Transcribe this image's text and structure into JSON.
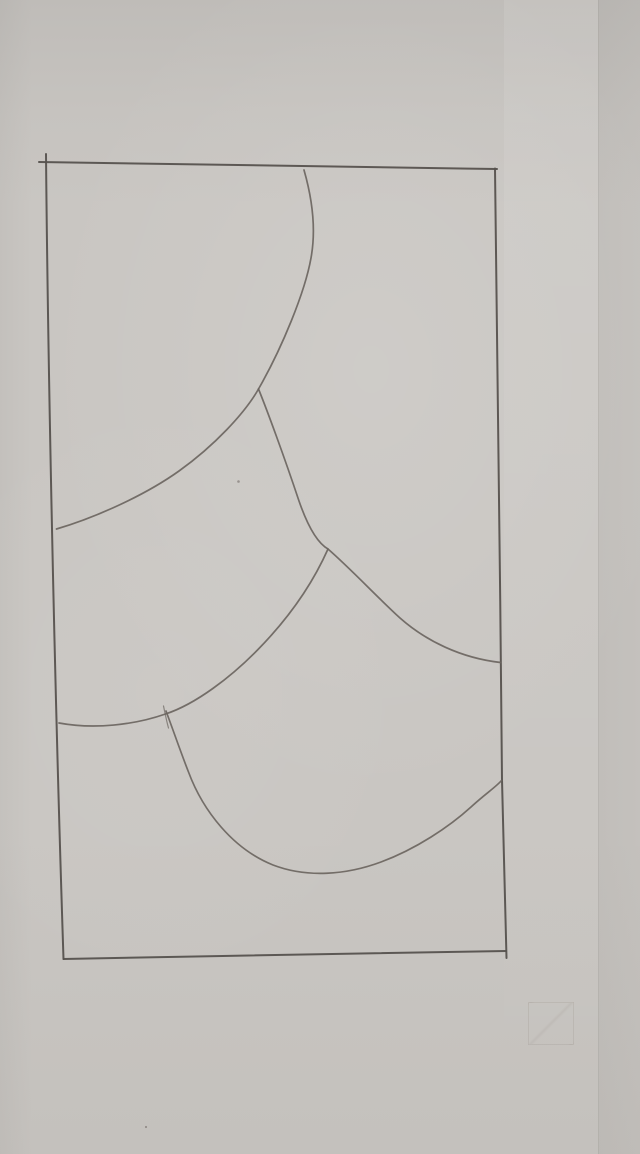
{
  "meta": {
    "description": "Photograph of a pencil sketch on gray paper: a tall rectangle containing five overlapping scallop (fish-scale) curves",
    "canvas": {
      "width": 640,
      "height": 1154
    }
  },
  "palette": {
    "paper": "#c9c6c2",
    "paper_shadow": "#bdbab7",
    "pencil": "#6b6560",
    "pencil_dark": "#56524e"
  },
  "drawing": {
    "frame": [
      {
        "name": "top-edge",
        "d": "M 39,162 C 160,164 330,166.5 497,169"
      },
      {
        "name": "left-edge",
        "d": "M 46,154 C 47.5,320 53,640 63.5,959"
      },
      {
        "name": "bottom-edge",
        "d": "M 63.5,959 C 210,956 390,953 506,951"
      },
      {
        "name": "right-edge",
        "d": "M 495,168.5 C 497.5,330 500,570 502,780 C 503.5,850 505,915 506.5,958"
      }
    ],
    "curves": [
      {
        "name": "top-scale-arc",
        "d": "M 304,170 C 312,198 316.5,228 311,258 C 305,292 282,348 258.5,389"
      },
      {
        "name": "left-scale-arc",
        "d": "M 258.5,389 C 245,413 214,446 179,471 C 144,496 94,518 56.5,529"
      },
      {
        "name": "middle-scale-arc",
        "d": "M 258.5,389 C 267,410 284,456 299,501 C 308,527 317.5,543 328,549 C 352,570 376,596 400,618 C 426,641 461,658 500.5,662.5"
      },
      {
        "name": "lower-left-scale-arc",
        "d": "M 328,549 C 312,585 288,619 257.5,650 C 231,677 196,704 165.5,714 C 134,725 94,729.5 59,723"
      },
      {
        "name": "bottom-scale-arc",
        "d": "M 166,711 C 173.5,731 181,753 188.5,772 C 203,811 233,849 273,865 C 307,878 346,875 381,862 C 416,849 449,827 471,807 C 485,794 496,787 501.5,780.5"
      },
      {
        "name": "bottom-scale-start-tick",
        "d": "M 163.5,706 C 165,713 166.5,721 168.5,728"
      }
    ],
    "specks": [
      {
        "x": 238.5,
        "y": 481.5,
        "r": 1.3
      },
      {
        "x": 146,
        "y": 1127,
        "r": 1.1
      }
    ]
  }
}
